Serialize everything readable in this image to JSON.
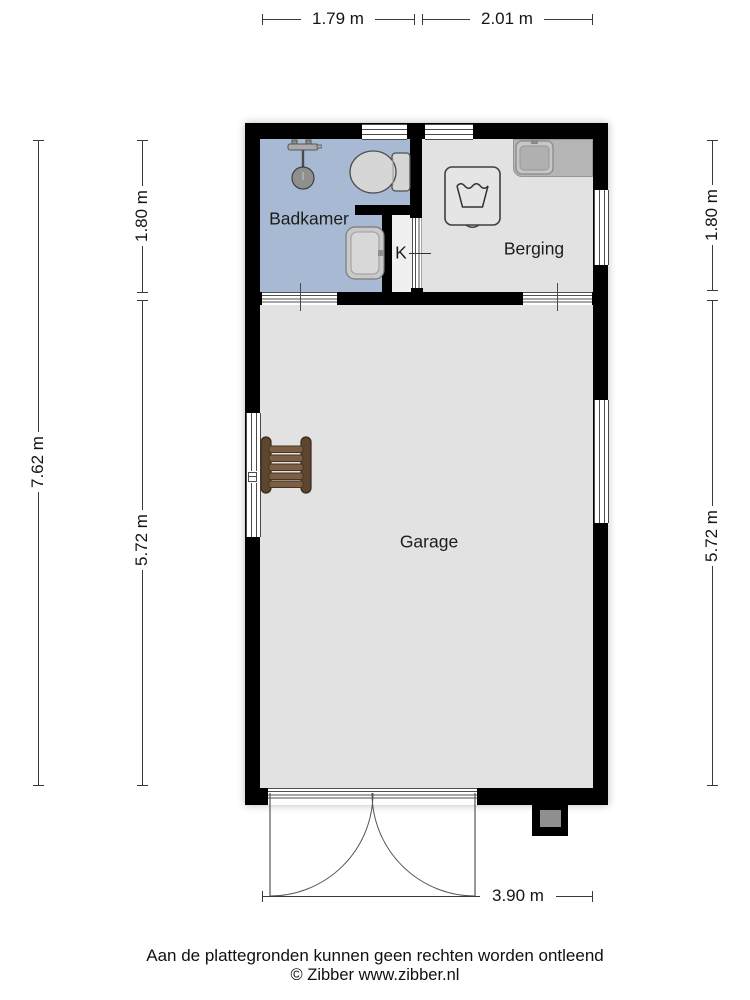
{
  "floorplan": {
    "rooms": {
      "bathroom": {
        "label": "Badkamer"
      },
      "storage": {
        "label": "Berging"
      },
      "garage": {
        "label": "Garage"
      },
      "closet": {
        "label": "K"
      }
    },
    "dimensions": {
      "top_bathroom": "1.79 m",
      "top_storage": "2.01 m",
      "left_total": "7.62 m",
      "left_top": "1.80 m",
      "left_bottom": "5.72 m",
      "right_top": "1.80 m",
      "right_bottom": "5.72 m",
      "bottom_garage": "3.90 m"
    },
    "icons": {
      "shower": "shower-icon",
      "toilet": "toilet-icon",
      "sink": "sink-icon",
      "washing_machine": "washing-machine-icon",
      "counter_sink": "counter-sink-icon",
      "bench": "bench-icon"
    },
    "colors": {
      "wall": "#000000",
      "bathroom_floor": "#a8bad3",
      "room_floor": "#e2e2e2",
      "closet_floor": "#f0f0f0",
      "counter": "#b5b5b5",
      "fixture_fill": "#d6d6d6",
      "bench_wood": "#6b4e36",
      "dimension_line": "#3a3a3a"
    }
  },
  "footer": {
    "disclaimer": "Aan de plattegronden kunnen geen rechten worden ontleend",
    "copyright": "© Zibber www.zibber.nl"
  }
}
